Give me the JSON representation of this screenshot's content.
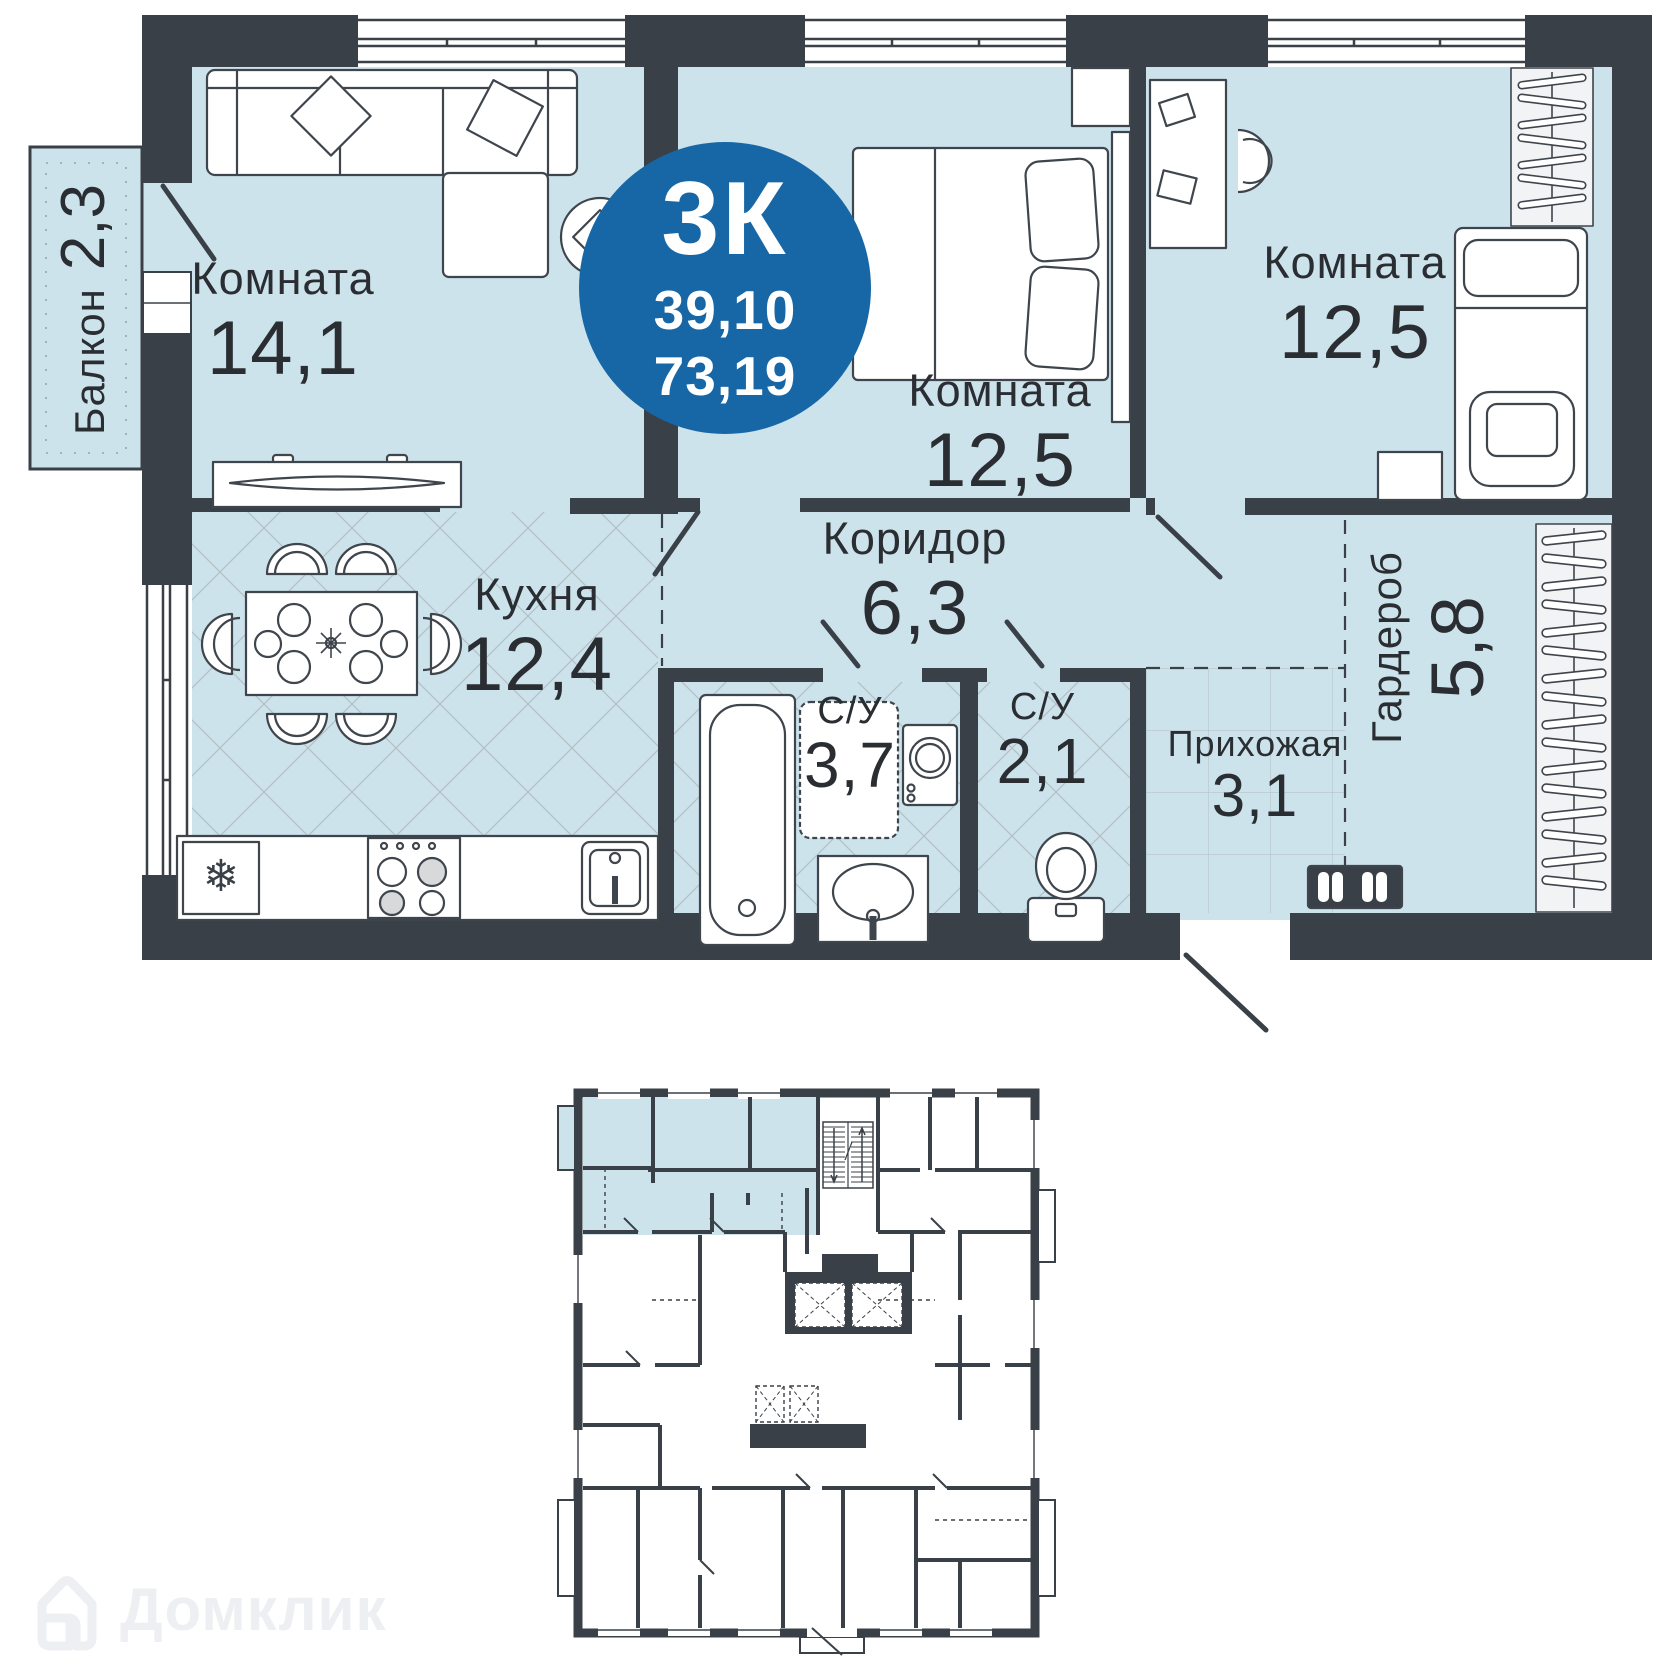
{
  "badge": {
    "rooms_label": "3К",
    "area_living": "39,10",
    "area_total": "73,19"
  },
  "rooms": {
    "balcony": {
      "label": "Балкон",
      "area": "2,3"
    },
    "living": {
      "label": "Комната",
      "area": "14,1"
    },
    "bedroom_middle": {
      "label": "Комната",
      "area": "12,5"
    },
    "bedroom_right": {
      "label": "Комната",
      "area": "12,5"
    },
    "kitchen": {
      "label": "Кухня",
      "area": "12,4"
    },
    "corridor": {
      "label": "Коридор",
      "area": "6,3"
    },
    "bathroom": {
      "label": "С/У",
      "area": "3,7"
    },
    "wc": {
      "label": "С/У",
      "area": "2,1"
    },
    "hallway": {
      "label": "Прихожая",
      "area": "3,1"
    },
    "wardrobe": {
      "label": "Гардероб",
      "area": "5,8"
    }
  },
  "icons": {
    "fridge_snowflake": "❄"
  },
  "watermark": {
    "brand": "Домклик"
  },
  "colors": {
    "wall": "#3A4047",
    "floor": "#CDE3EC",
    "badge_blue": "#1767A7",
    "text": "#2A2E33",
    "tile_line": "#AAB1B7",
    "watermark": "#EDEFF2"
  }
}
